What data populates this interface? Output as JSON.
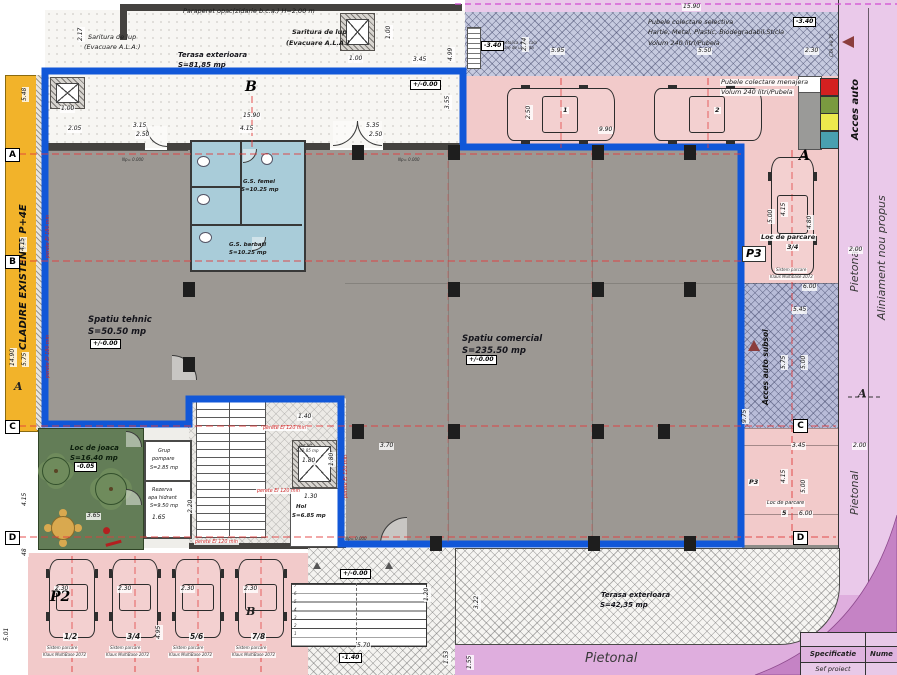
{
  "title": "Plan parter - ansamblu comercial si parcari",
  "colors": {
    "blue_boundary": "#1157d8",
    "yellow_existing": "#f2b32a",
    "gray_room": "#9c9893",
    "wall_dark": "#44423f",
    "toilet_blue": "#a9ccd9",
    "pink_parking": "#f2caca",
    "waste_band": "#c6cadf",
    "ramp_blue": "#b8bcd8",
    "purple_light": "#eac9ea",
    "purple_mid": "#dfaede",
    "purple_dark": "#c583c5",
    "green_playground": "#637d57",
    "axis_red": "#e23d3d",
    "fire_text_red": "#cc2525",
    "arrow_maroon": "#8b3d3d",
    "bin_colors": [
      "#d42020",
      "#7a9a40",
      "#ede94d",
      "#49a0b0"
    ]
  },
  "texts": [
    {
      "n": "note-paraperet",
      "t": "Paraperet opac(zidarie b.c.a.) H=2.00 m",
      "x": 183,
      "y": 8,
      "k": "n6"
    },
    {
      "n": "note-saritura-1a",
      "t": "Saritura de lup",
      "x": 88,
      "y": 34,
      "k": "n6"
    },
    {
      "n": "note-saritura-1b",
      "t": "(Evacuare A.L.A.)",
      "x": 84,
      "y": 44,
      "k": "n6"
    },
    {
      "n": "room-terasa-top-name",
      "t": "Terasa exterioara",
      "x": 178,
      "y": 51,
      "k": "rm7"
    },
    {
      "n": "room-terasa-top-area",
      "t": "S=81,85 mp",
      "x": 178,
      "y": 61,
      "k": "rm7"
    },
    {
      "n": "note-saritura-2a",
      "t": "Saritura de lup",
      "x": 292,
      "y": 29,
      "k": "n6b"
    },
    {
      "n": "note-saritura-2b",
      "t": "(Evacuare A.L.A.)",
      "x": 286,
      "y": 40,
      "k": "n6b"
    },
    {
      "n": "note-pubele-sel-1",
      "t": "Pubele colectare selectiva",
      "x": 648,
      "y": 19,
      "k": "n6"
    },
    {
      "n": "note-pubele-sel-2",
      "t": "Hartie, Metal, Plastic, Biodegradabil,Sticla",
      "x": 648,
      "y": 29,
      "k": "n6"
    },
    {
      "n": "note-pubele-sel-3",
      "t": "Volum 240 litri/Pubela",
      "x": 648,
      "y": 40,
      "k": "n6"
    },
    {
      "n": "note-pubele-men-1",
      "t": "Pubele colectare menajera",
      "x": 720,
      "y": 79,
      "k": "n6",
      "h": 1
    },
    {
      "n": "note-pubele-men-2",
      "t": "Volum 240 litri/Pubela",
      "x": 720,
      "y": 89,
      "k": "n6",
      "h": 1
    },
    {
      "n": "note-scara-met-1",
      "t": "scara metalica verticala",
      "x": 489,
      "y": 41,
      "k": "mic"
    },
    {
      "n": "note-scara-met-2",
      "t": "evacuare de urgenta",
      "x": 492,
      "y": 46,
      "k": "mic"
    },
    {
      "n": "street-cta",
      "t": "CTA +9.75",
      "x": 831,
      "y": 57,
      "k": "vt4",
      "r": 1
    },
    {
      "n": "street-acces-auto",
      "t": "Acces auto",
      "x": 851,
      "y": 140,
      "k": "v9b",
      "r": 1
    },
    {
      "n": "street-aliniament",
      "t": "Aliniament nou propus",
      "x": 876,
      "y": 320,
      "k": "v11",
      "r": 1
    },
    {
      "n": "street-pietonal-1",
      "t": "Pietonal",
      "x": 849,
      "y": 292,
      "k": "v11",
      "r": 1
    },
    {
      "n": "street-pietonal-2",
      "t": "Pietonal",
      "x": 849,
      "y": 515,
      "k": "v11",
      "r": 1
    },
    {
      "n": "street-pietonal-3",
      "t": "Pietonal",
      "x": 585,
      "y": 652,
      "k": "pt13"
    },
    {
      "n": "existing-building",
      "t": "CLADIRE EXISTENTA P+4E",
      "x": 19,
      "y": 350,
      "k": "v9b",
      "r": 1
    },
    {
      "n": "room-tehnic-name",
      "t": "Spatiu tehnic",
      "x": 88,
      "y": 315,
      "k": "rm"
    },
    {
      "n": "room-tehnic-area",
      "t": "S=50.50 mp",
      "x": 88,
      "y": 327,
      "k": "rm"
    },
    {
      "n": "room-comercial-name",
      "t": "Spatiu comercial",
      "x": 462,
      "y": 334,
      "k": "rm"
    },
    {
      "n": "room-comercial-area",
      "t": "S=235.50 mp",
      "x": 462,
      "y": 346,
      "k": "rm"
    },
    {
      "n": "room-gs-femei-name",
      "t": "G.S. femei",
      "x": 243,
      "y": 179,
      "k": "n5b"
    },
    {
      "n": "room-gs-femei-area",
      "t": "S=10.25 mp",
      "x": 241,
      "y": 187,
      "k": "n5b"
    },
    {
      "n": "room-gs-barbati-name",
      "t": "G.S. barbati",
      "x": 229,
      "y": 242,
      "k": "n5b"
    },
    {
      "n": "room-gs-barbati-area",
      "t": "S=10.25 mp",
      "x": 229,
      "y": 250,
      "k": "n5b"
    },
    {
      "n": "room-joaca-name",
      "t": "Loc de joaca",
      "x": 70,
      "y": 444,
      "k": "joaca"
    },
    {
      "n": "room-joaca-area",
      "t": "S=16.40 mp",
      "x": 70,
      "y": 454,
      "k": "joaca"
    },
    {
      "n": "room-pompare-1",
      "t": "Grup",
      "x": 158,
      "y": 449,
      "k": "n5"
    },
    {
      "n": "room-pompare-2",
      "t": "pompare",
      "x": 152,
      "y": 457,
      "k": "n5"
    },
    {
      "n": "room-pompare-3",
      "t": "S=2.85 mp",
      "x": 150,
      "y": 466,
      "k": "n5"
    },
    {
      "n": "room-rezerva-1",
      "t": "Rezerva",
      "x": 152,
      "y": 488,
      "k": "n5"
    },
    {
      "n": "room-rezerva-2",
      "t": "apa hidrant",
      "x": 148,
      "y": 496,
      "k": "n5"
    },
    {
      "n": "room-rezerva-3",
      "t": "S=9.50 mp",
      "x": 150,
      "y": 504,
      "k": "n5"
    },
    {
      "n": "room-hol-name",
      "t": "Hol",
      "x": 296,
      "y": 504,
      "k": "n5b"
    },
    {
      "n": "room-hol-area",
      "t": "S=6.85 mp",
      "x": 292,
      "y": 513,
      "k": "n5b"
    },
    {
      "n": "room-putlift-name",
      "t": "Put lift",
      "x": 299,
      "y": 444,
      "k": "mic"
    },
    {
      "n": "room-putlift-area",
      "t": "S=2.85 mp",
      "x": 296,
      "y": 449,
      "k": "mic"
    },
    {
      "n": "parking-34-label",
      "t": "Loc de parcare",
      "x": 760,
      "y": 234,
      "k": "n6b",
      "h": 1
    },
    {
      "n": "parking-34-num",
      "t": "3/4",
      "x": 786,
      "y": 244,
      "k": "n6b",
      "h": 1
    },
    {
      "n": "parking-34-sys1",
      "t": "Sistem parcare",
      "x": 775,
      "y": 268,
      "k": "mic",
      "h": 1
    },
    {
      "n": "parking-34-sys2",
      "t": "Klaus Multibase 2072",
      "x": 769,
      "y": 275,
      "k": "mic",
      "h": 1
    },
    {
      "n": "ramp-label",
      "t": "Acces auto subsol",
      "x": 762,
      "y": 405,
      "k": "v7b",
      "r": 1
    },
    {
      "n": "parking-5-label",
      "t": "Loc de parcare",
      "x": 766,
      "y": 501,
      "k": "n5",
      "h": 1
    },
    {
      "n": "parking-5-num",
      "t": "5",
      "x": 781,
      "y": 510,
      "k": "n6b",
      "h": 1
    },
    {
      "n": "parking-p3-small",
      "t": "P3",
      "x": 748,
      "y": 479,
      "k": "n6b",
      "h": 1
    },
    {
      "n": "room-terasa-bot-name",
      "t": "Terasa exterioara",
      "x": 601,
      "y": 591,
      "k": "rm7"
    },
    {
      "n": "room-terasa-bot-area",
      "t": "S=42,35 mp",
      "x": 600,
      "y": 601,
      "k": "rm7"
    },
    {
      "n": "parking-b1-sys1",
      "t": "Sistem parcare",
      "x": 46,
      "y": 646,
      "k": "mic",
      "h": 1
    },
    {
      "n": "parking-b1-sys2",
      "t": "Klaus MultiBase 2072",
      "x": 42,
      "y": 653,
      "k": "mic",
      "h": 1
    },
    {
      "n": "parking-b2-sys1",
      "t": "Sistem parcare",
      "x": 109,
      "y": 646,
      "k": "mic",
      "h": 1
    },
    {
      "n": "parking-b2-sys2",
      "t": "Klaus MultiBase 2072",
      "x": 105,
      "y": 653,
      "k": "mic",
      "h": 1
    },
    {
      "n": "parking-b3-sys1",
      "t": "Sistem parcare",
      "x": 172,
      "y": 646,
      "k": "mic",
      "h": 1
    },
    {
      "n": "parking-b3-sys2",
      "t": "Klaus MultiBase 2072",
      "x": 168,
      "y": 653,
      "k": "mic",
      "h": 1
    },
    {
      "n": "parking-b4-sys1",
      "t": "Sistem parcare",
      "x": 235,
      "y": 646,
      "k": "mic",
      "h": 1
    },
    {
      "n": "parking-b4-sys2",
      "t": "Klaus MultiBase 2072",
      "x": 231,
      "y": 653,
      "k": "mic",
      "h": 1
    },
    {
      "n": "level-np-1",
      "t": "Np= 0.000",
      "x": 122,
      "y": 158,
      "k": "mic"
    },
    {
      "n": "level-np-2",
      "t": "Np= 0.000",
      "x": 398,
      "y": 158,
      "k": "mic"
    },
    {
      "n": "level-np-3",
      "t": "Np= 0.000",
      "x": 345,
      "y": 537,
      "k": "mic"
    },
    {
      "n": "fire-1",
      "t": "perete EI 120 min",
      "x": 262,
      "y": 426,
      "k": "red5",
      "h": 1
    },
    {
      "n": "fire-2",
      "t": "perete EI 120 min",
      "x": 256,
      "y": 489,
      "k": "red5",
      "h": 1
    },
    {
      "n": "fire-3",
      "t": "perete EI 120 min",
      "x": 194,
      "y": 540,
      "k": "red5",
      "h": 1
    },
    {
      "n": "fire-4",
      "t": "perete EI 120 min",
      "x": 344,
      "y": 498,
      "k": "red5",
      "r": 1
    },
    {
      "n": "fire-5",
      "t": "perete EI 180 min",
      "x": 46,
      "y": 258,
      "k": "red5",
      "r": 1
    },
    {
      "n": "fire-6",
      "t": "perete EI 180 min",
      "x": 46,
      "y": 378,
      "k": "red5",
      "r": 1
    },
    {
      "n": "parking-top-num-1",
      "t": "1",
      "x": 562,
      "y": 107,
      "k": "n6b",
      "h": 1
    },
    {
      "n": "parking-top-num-2",
      "t": "2",
      "x": 714,
      "y": 107,
      "k": "n6b",
      "h": 1
    },
    {
      "n": "parking-b1-num",
      "t": "1/2",
      "x": 63,
      "y": 633,
      "k": "n7b",
      "h": 1
    },
    {
      "n": "parking-b2-num",
      "t": "3/4",
      "x": 126,
      "y": 633,
      "k": "n7b",
      "h": 1
    },
    {
      "n": "parking-b3-num",
      "t": "5/6",
      "x": 189,
      "y": 633,
      "k": "n7b",
      "h": 1
    },
    {
      "n": "parking-b4-num",
      "t": "7/8",
      "x": 251,
      "y": 633,
      "k": "n7b",
      "h": 1
    },
    {
      "n": "dim",
      "t": "2.17",
      "x": 78,
      "y": 42,
      "k": "dim",
      "r": 1
    },
    {
      "n": "dim",
      "t": "5.48",
      "x": 22,
      "y": 102,
      "k": "dim",
      "r": 1
    },
    {
      "n": "dim",
      "t": "1.00",
      "x": 60,
      "y": 106,
      "k": "dim"
    },
    {
      "n": "dim",
      "t": "2.05",
      "x": 67,
      "y": 126,
      "k": "dim"
    },
    {
      "n": "dim",
      "t": "3.15",
      "x": 132,
      "y": 123,
      "k": "dim"
    },
    {
      "n": "dim",
      "t": "2.50",
      "x": 135,
      "y": 132,
      "k": "dim"
    },
    {
      "n": "dim",
      "t": "15.90",
      "x": 242,
      "y": 113,
      "k": "dim"
    },
    {
      "n": "dim",
      "t": "4.15",
      "x": 239,
      "y": 126,
      "k": "dim"
    },
    {
      "n": "dim",
      "t": "5.35",
      "x": 365,
      "y": 123,
      "k": "dim"
    },
    {
      "n": "dim",
      "t": "2.50",
      "x": 368,
      "y": 132,
      "k": "dim"
    },
    {
      "n": "dim",
      "t": "1.00",
      "x": 386,
      "y": 40,
      "k": "dim",
      "r": 1
    },
    {
      "n": "dim",
      "t": "1.00",
      "x": 348,
      "y": 56,
      "k": "dim"
    },
    {
      "n": "dim",
      "t": "3.45",
      "x": 412,
      "y": 57,
      "k": "dim"
    },
    {
      "n": "dim",
      "t": "4.99",
      "x": 448,
      "y": 62,
      "k": "dim",
      "r": 1
    },
    {
      "n": "dim",
      "t": "3.55",
      "x": 445,
      "y": 110,
      "k": "dim",
      "r": 1
    },
    {
      "n": "dim",
      "t": "15.90",
      "x": 682,
      "y": 4,
      "k": "dim"
    },
    {
      "n": "dim",
      "t": "2.74",
      "x": 522,
      "y": 52,
      "k": "dim",
      "r": 1
    },
    {
      "n": "dim",
      "t": "5.95",
      "x": 550,
      "y": 48,
      "k": "dim"
    },
    {
      "n": "dim",
      "t": "5.50",
      "x": 697,
      "y": 48,
      "k": "dim"
    },
    {
      "n": "dim",
      "t": "2.30",
      "x": 804,
      "y": 48,
      "k": "dim"
    },
    {
      "n": "dim",
      "t": "2.50",
      "x": 526,
      "y": 120,
      "k": "dim",
      "r": 1
    },
    {
      "n": "dim",
      "t": "9.90",
      "x": 598,
      "y": 127,
      "k": "dim"
    },
    {
      "n": "dim",
      "t": "4.15",
      "x": 781,
      "y": 217,
      "k": "dim",
      "r": 1
    },
    {
      "n": "dim",
      "t": "5.00",
      "x": 768,
      "y": 224,
      "k": "dim",
      "r": 1
    },
    {
      "n": "dim",
      "t": "4.80",
      "x": 807,
      "y": 230,
      "k": "dim",
      "r": 1
    },
    {
      "n": "dim",
      "t": "2.00",
      "x": 848,
      "y": 247,
      "k": "dim"
    },
    {
      "n": "dim",
      "t": "6.00",
      "x": 802,
      "y": 284,
      "k": "dim"
    },
    {
      "n": "dim",
      "t": "5.45",
      "x": 792,
      "y": 307,
      "k": "dim"
    },
    {
      "n": "dim",
      "t": "5.75",
      "x": 781,
      "y": 370,
      "k": "dim",
      "r": 1
    },
    {
      "n": "dim",
      "t": "5.00",
      "x": 801,
      "y": 370,
      "k": "dim",
      "r": 1
    },
    {
      "n": "dim",
      "t": "9.75",
      "x": 742,
      "y": 424,
      "k": "dim",
      "r": 1
    },
    {
      "n": "dim",
      "t": "3.45",
      "x": 791,
      "y": 443,
      "k": "dim"
    },
    {
      "n": "dim",
      "t": "2.00",
      "x": 852,
      "y": 443,
      "k": "dim"
    },
    {
      "n": "dim",
      "t": "4.15",
      "x": 781,
      "y": 484,
      "k": "dim",
      "r": 1
    },
    {
      "n": "dim",
      "t": "5.00",
      "x": 801,
      "y": 494,
      "k": "dim",
      "r": 1
    },
    {
      "n": "dim",
      "t": "6.00",
      "x": 798,
      "y": 511,
      "k": "dim"
    },
    {
      "n": "dim",
      "t": "4.15",
      "x": 20,
      "y": 252,
      "k": "dim",
      "r": 1
    },
    {
      "n": "dim",
      "t": "14.90",
      "x": 10,
      "y": 367,
      "k": "dim",
      "r": 1
    },
    {
      "n": "dim",
      "t": "5.75",
      "x": 22,
      "y": 367,
      "k": "dim",
      "r": 1
    },
    {
      "n": "dim",
      "t": "4.15",
      "x": 22,
      "y": 507,
      "k": "dim",
      "r": 1
    },
    {
      "n": "dim",
      "t": "48",
      "x": 22,
      "y": 557,
      "k": "dim",
      "r": 1
    },
    {
      "n": "dim",
      "t": "5.01",
      "x": 4,
      "y": 642,
      "k": "dim",
      "r": 1
    },
    {
      "n": "dim",
      "t": "2.30",
      "x": 54,
      "y": 586,
      "k": "dim"
    },
    {
      "n": "dim",
      "t": "2.30",
      "x": 117,
      "y": 586,
      "k": "dim"
    },
    {
      "n": "dim",
      "t": "2.30",
      "x": 180,
      "y": 586,
      "k": "dim"
    },
    {
      "n": "dim",
      "t": "2.30",
      "x": 243,
      "y": 586,
      "k": "dim"
    },
    {
      "n": "dim",
      "t": "4.95",
      "x": 156,
      "y": 640,
      "k": "dim",
      "r": 1
    },
    {
      "n": "dim",
      "t": "5.70",
      "x": 356,
      "y": 643,
      "k": "dim"
    },
    {
      "n": "dim",
      "t": "1.20",
      "x": 424,
      "y": 602,
      "k": "dim",
      "r": 1
    },
    {
      "n": "dim",
      "t": "1.53",
      "x": 444,
      "y": 665,
      "k": "dim",
      "r": 1
    },
    {
      "n": "dim",
      "t": "3.22",
      "x": 474,
      "y": 610,
      "k": "dim",
      "r": 1
    },
    {
      "n": "dim",
      "t": "1.55",
      "x": 467,
      "y": 670,
      "k": "dim",
      "r": 1
    },
    {
      "n": "dim",
      "t": "1.40",
      "x": 297,
      "y": 414,
      "k": "dim"
    },
    {
      "n": "dim",
      "t": "1.80",
      "x": 301,
      "y": 458,
      "k": "dim"
    },
    {
      "n": "dim",
      "t": "1.80",
      "x": 329,
      "y": 467,
      "k": "dim",
      "r": 1
    },
    {
      "n": "dim",
      "t": "1.30",
      "x": 303,
      "y": 494,
      "k": "dim"
    },
    {
      "n": "dim",
      "t": "3.70",
      "x": 379,
      "y": 443,
      "k": "dim"
    },
    {
      "n": "dim",
      "t": "1.65",
      "x": 151,
      "y": 515,
      "k": "dim"
    },
    {
      "n": "dim",
      "t": "2.20",
      "x": 188,
      "y": 514,
      "k": "dim",
      "r": 1
    },
    {
      "n": "dim",
      "t": "3.65",
      "x": 86,
      "y": 513,
      "k": "dim"
    },
    {
      "n": "elev",
      "t": "+/-0.00",
      "x": 410,
      "y": 80,
      "k": "elev"
    },
    {
      "n": "elev",
      "t": "+/-0.00",
      "x": 90,
      "y": 339,
      "k": "elev"
    },
    {
      "n": "elev",
      "t": "+/-0.00",
      "x": 466,
      "y": 355,
      "k": "elev"
    },
    {
      "n": "elev",
      "t": "+/-0.00",
      "x": 340,
      "y": 569,
      "k": "elev"
    },
    {
      "n": "elev",
      "t": "-3.40",
      "x": 793,
      "y": 17,
      "k": "elev"
    },
    {
      "n": "elev",
      "t": "-3.40",
      "x": 481,
      "y": 41,
      "k": "elev"
    },
    {
      "n": "elev",
      "t": "-1.40",
      "x": 339,
      "y": 653,
      "k": "elev"
    },
    {
      "n": "elev",
      "t": "-0.05",
      "x": 74,
      "y": 462,
      "k": "elev"
    }
  ],
  "markers": [
    {
      "t": "A",
      "x": 5,
      "y": 148,
      "k": "box"
    },
    {
      "t": "B",
      "x": 5,
      "y": 255,
      "k": "box"
    },
    {
      "t": "C",
      "x": 5,
      "y": 420,
      "k": "box"
    },
    {
      "t": "D",
      "x": 5,
      "y": 531,
      "k": "box"
    },
    {
      "t": "C",
      "x": 793,
      "y": 419,
      "k": "box"
    },
    {
      "t": "D",
      "x": 793,
      "y": 531,
      "k": "box"
    },
    {
      "t": "B",
      "x": 245,
      "y": 80,
      "k": "big"
    },
    {
      "t": "A",
      "x": 799,
      "y": 149,
      "k": "big"
    },
    {
      "t": "P2",
      "x": 50,
      "y": 590,
      "k": "big"
    },
    {
      "t": "B",
      "x": 246,
      "y": 606,
      "k": "ital"
    },
    {
      "t": "A",
      "x": 14,
      "y": 381,
      "k": "ital"
    },
    {
      "t": "A",
      "x": 858,
      "y": 388,
      "k": "ital"
    },
    {
      "t": "P3",
      "x": 742,
      "y": 246,
      "k": "p3box"
    }
  ],
  "stair": {
    "numbers": [
      "1",
      "2",
      "3",
      "4",
      "5",
      "6",
      "7"
    ]
  },
  "table": {
    "header": [
      "Specificatie",
      "Nume"
    ],
    "rows": [
      [
        "Sef proiect",
        ""
      ]
    ]
  },
  "columns": [
    [
      352,
      145
    ],
    [
      448,
      145
    ],
    [
      592,
      145
    ],
    [
      684,
      145
    ],
    [
      448,
      282
    ],
    [
      592,
      282
    ],
    [
      684,
      282
    ],
    [
      352,
      424
    ],
    [
      448,
      424
    ],
    [
      592,
      424
    ],
    [
      658,
      424
    ],
    [
      430,
      536
    ],
    [
      588,
      536
    ],
    [
      684,
      536
    ],
    [
      183,
      282
    ],
    [
      183,
      357
    ]
  ],
  "cars": [
    {
      "x": 505,
      "y": 86,
      "w": 112,
      "h": 57,
      "o": "h",
      "name": "car-top-1"
    },
    {
      "x": 652,
      "y": 86,
      "w": 112,
      "h": 57,
      "o": "h",
      "name": "car-top-2"
    },
    {
      "x": 769,
      "y": 155,
      "w": 47,
      "h": 122,
      "o": "v",
      "name": "car-right-34"
    },
    {
      "x": 47,
      "y": 557,
      "w": 50,
      "h": 83,
      "o": "v",
      "name": "car-bottom-12"
    },
    {
      "x": 110,
      "y": 557,
      "w": 50,
      "h": 83,
      "o": "v",
      "name": "car-bottom-34"
    },
    {
      "x": 173,
      "y": 557,
      "w": 50,
      "h": 83,
      "o": "v",
      "name": "car-bottom-56"
    },
    {
      "x": 236,
      "y": 557,
      "w": 50,
      "h": 83,
      "o": "v",
      "name": "car-bottom-78"
    }
  ]
}
